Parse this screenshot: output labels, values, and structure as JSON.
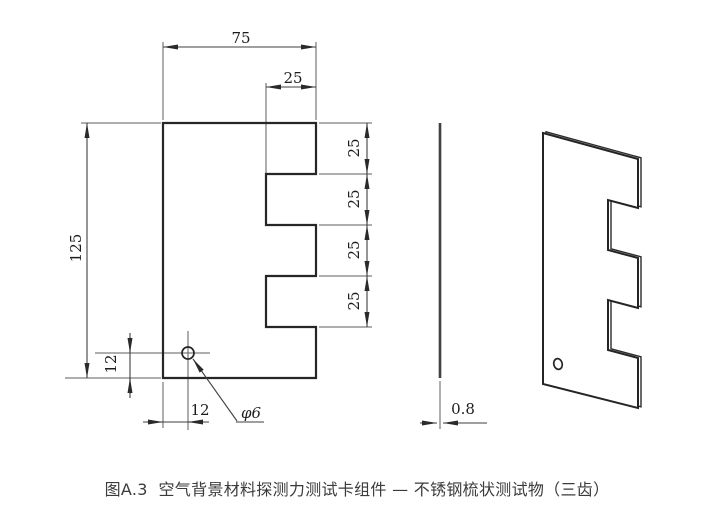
{
  "figure": {
    "caption": "图A.3  空气背景材料探测力测试卡组件 — 不锈钢梳状测试物（三齿）"
  },
  "front_view": {
    "dim_width_top": "75",
    "dim_tooth_width": "25",
    "dim_height": "125",
    "dim_pitch": [
      "25",
      "25",
      "25",
      "25"
    ],
    "dim_hole_offset_y": "12",
    "dim_hole_offset_x": "12",
    "dim_hole_diameter": "φ6"
  },
  "side_view": {
    "dim_thickness": "0.8"
  },
  "colors": {
    "background": "#ffffff",
    "outline": "#262626",
    "thin_line": "#5d5d5d",
    "dimension_text": "#1c1c1c",
    "caption_text": "#3b3b3b"
  }
}
